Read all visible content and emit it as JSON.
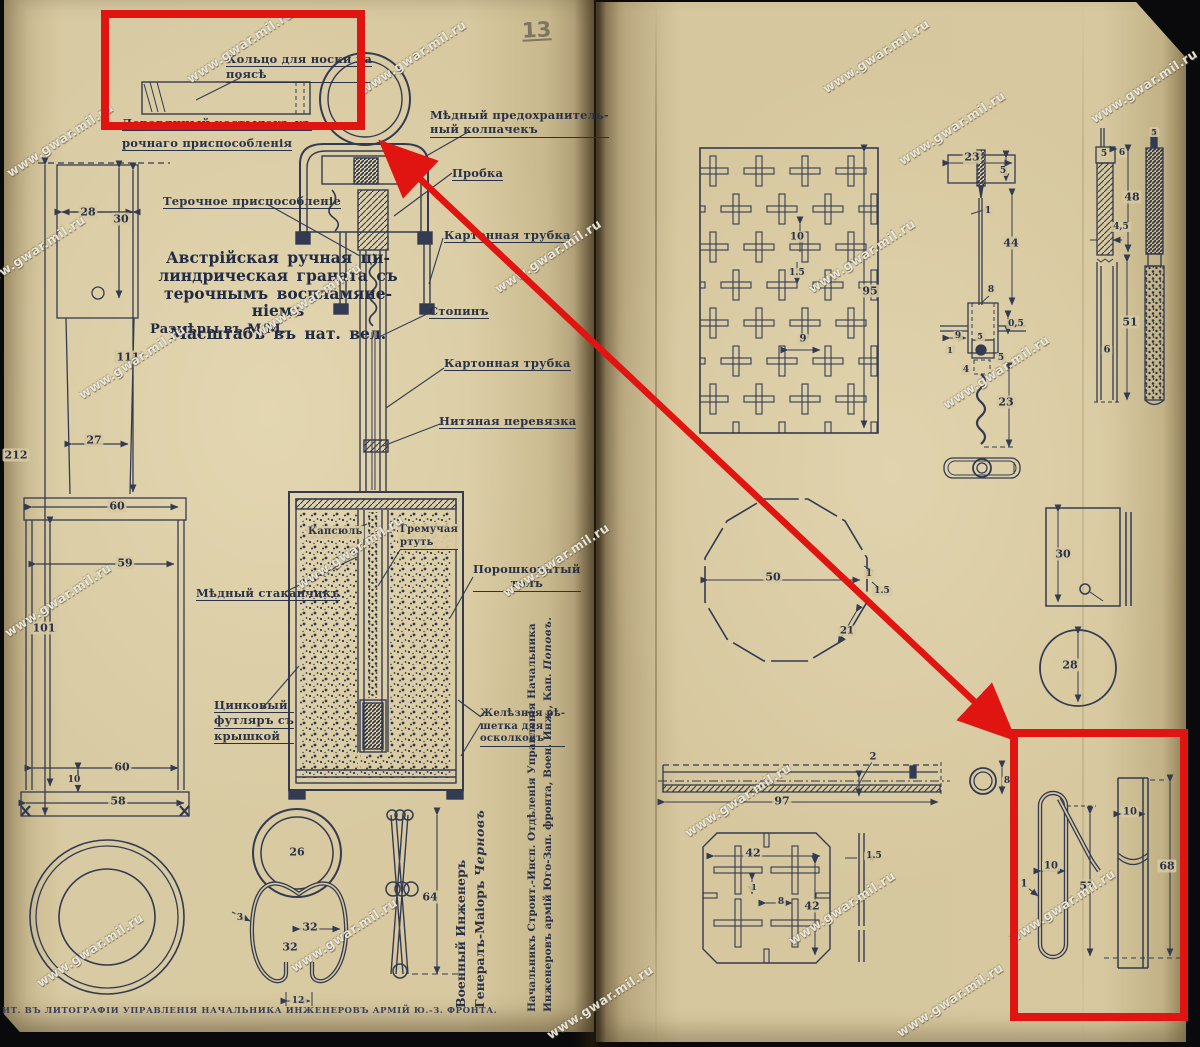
{
  "watermark_text": "www.gwar.mil.ru",
  "page_number": "13",
  "title": {
    "lines": [
      "Австрійская  ручная  ци-",
      "линдрическая  граната съ",
      "терочнымъ  воспламяне-",
      "ніемъ"
    ],
    "scale": "Масштабъ  въ  нат.  вел.",
    "units": "Размѣры  въ  М/М."
  },
  "footer": "ИТ.  ВЪ  ЛИТОГРАФІИ  УПРАВЛЕНІЯ  НАЧАЛЬНИКА  ИНЖЕНЕРОВЪ  АРМІЙ  Ю.-З.  ФРОНТА.",
  "signatures": {
    "engineer_line1": "Военный  Инженеръ",
    "engineer_line2": "Генералъ-Маіоръ  ",
    "engineer_name": "Черновъ",
    "chief_line1": "Начальникъ  Строит.-Инсп.  Отдѣленія  Управленія  Начальника",
    "chief_line2": "Инженеровъ  армій  Юго-Зап.  фронта,  Воен.  Инж.,  Кап.  ",
    "chief_name": "Поповъ."
  },
  "labels": [
    {
      "id": "label-belt-ring",
      "x": 226,
      "y": 52,
      "u": "all",
      "lines": [
        "Кольцо  для  носки   на",
        "поясѣ"
      ]
    },
    {
      "id": "label-wooden-toggle",
      "x": 122,
      "y": 116,
      "u": "all",
      "lines": [
        "Деревянный  костылекъ  къ"
      ]
    },
    {
      "id": "label-wooden-toggle-2",
      "x": 122,
      "y": 136,
      "u": "all",
      "lines": [
        "рочнаго  приспособленія"
      ]
    },
    {
      "id": "label-copper-cap",
      "x": 430,
      "y": 108,
      "u": "last",
      "lines": [
        "Мѣдный   предохранитель-",
        "ный  колпачекъ"
      ]
    },
    {
      "id": "label-cork",
      "x": 452,
      "y": 166,
      "u": "all",
      "lines": [
        "Пробка"
      ]
    },
    {
      "id": "label-friction-device",
      "x": 163,
      "y": 194,
      "u": "all",
      "lines": [
        "Терочное  приспособленіе"
      ]
    },
    {
      "id": "label-cardboard-tube-1",
      "x": 444,
      "y": 228,
      "u": "all",
      "lines": [
        "Картонная  трубка"
      ]
    },
    {
      "id": "label-stopin",
      "x": 429,
      "y": 304,
      "u": "all",
      "lines": [
        "Стопинъ"
      ]
    },
    {
      "id": "label-cardboard-tube-2",
      "x": 444,
      "y": 356,
      "u": "all",
      "lines": [
        "Картонная  трубка"
      ]
    },
    {
      "id": "label-thread-binding",
      "x": 439,
      "y": 414,
      "u": "all",
      "lines": [
        "Нитяная  перевязка"
      ]
    },
    {
      "id": "label-capsule",
      "x": 306,
      "y": 526,
      "bg": true,
      "fs": 10,
      "lines": [
        "Капсюль"
      ]
    },
    {
      "id": "label-mercury-fulminate",
      "x": 398,
      "y": 524,
      "u": "last",
      "bg": true,
      "fs": 10,
      "lines": [
        "Гремучая",
        "ртуть"
      ]
    },
    {
      "id": "label-powdered-tol",
      "x": 473,
      "y": 562,
      "u": "last",
      "ta": "center",
      "lines": [
        "Порошковатый",
        "толъ"
      ]
    },
    {
      "id": "label-copper-cup",
      "x": 196,
      "y": 586,
      "u": "all",
      "lines": [
        "Мѣдный  стаканчикъ"
      ]
    },
    {
      "id": "label-zinc-case",
      "x": 214,
      "y": 698,
      "u": "all",
      "lines": [
        "Цинковый",
        "футляръ съ",
        "крышкой"
      ]
    },
    {
      "id": "label-iron-grate",
      "x": 480,
      "y": 708,
      "u": "last",
      "fs": 10,
      "lines": [
        "Желѣзная рѣ-",
        "шетка  для",
        "осколковъ"
      ]
    }
  ],
  "dimensions": [
    {
      "v": "28",
      "x": 88,
      "y": 212
    },
    {
      "v": "30",
      "x": 121,
      "y": 219
    },
    {
      "v": "111",
      "x": 128,
      "y": 357
    },
    {
      "v": "27",
      "x": 94,
      "y": 440
    },
    {
      "v": "212",
      "x": 16,
      "y": 455
    },
    {
      "v": "60",
      "x": 117,
      "y": 506
    },
    {
      "v": "59",
      "x": 125,
      "y": 563
    },
    {
      "v": "101",
      "x": 44,
      "y": 628
    },
    {
      "v": "60",
      "x": 122,
      "y": 767
    },
    {
      "v": "10",
      "x": 74,
      "y": 780,
      "fs": 9
    },
    {
      "v": "58",
      "x": 118,
      "y": 801
    },
    {
      "v": "26",
      "x": 297,
      "y": 852
    },
    {
      "v": "3",
      "x": 240,
      "y": 918,
      "fs": 9
    },
    {
      "v": "32",
      "x": 310,
      "y": 927
    },
    {
      "v": "32",
      "x": 290,
      "y": 947
    },
    {
      "v": "12",
      "x": 298,
      "y": 1001,
      "fs": 9
    },
    {
      "v": "64",
      "x": 430,
      "y": 897
    },
    {
      "v": "10",
      "x": 797,
      "y": 237,
      "fs": 10
    },
    {
      "v": "1.5",
      "x": 797,
      "y": 273,
      "fs": 9
    },
    {
      "v": "9",
      "x": 803,
      "y": 339,
      "fs": 10
    },
    {
      "v": "95",
      "x": 870,
      "y": 291
    },
    {
      "v": "23",
      "x": 972,
      "y": 157
    },
    {
      "v": "5",
      "x": 1003,
      "y": 171,
      "fs": 9
    },
    {
      "v": "1",
      "x": 988,
      "y": 211,
      "fs": 9
    },
    {
      "v": "44",
      "x": 1011,
      "y": 243
    },
    {
      "v": "8",
      "x": 991,
      "y": 290,
      "fs": 9
    },
    {
      "v": "0,5",
      "x": 1016,
      "y": 324,
      "fs": 9
    },
    {
      "v": "9",
      "x": 958,
      "y": 336,
      "fs": 9
    },
    {
      "v": "5",
      "x": 980,
      "y": 336,
      "fs": 8
    },
    {
      "v": "1",
      "x": 950,
      "y": 350,
      "fs": 8
    },
    {
      "v": "5",
      "x": 1001,
      "y": 358,
      "fs": 9
    },
    {
      "v": "4",
      "x": 966,
      "y": 370,
      "fs": 9
    },
    {
      "v": "23",
      "x": 1006,
      "y": 402
    },
    {
      "v": "5",
      "x": 1104,
      "y": 154,
      "fs": 9
    },
    {
      "v": "6",
      "x": 1122,
      "y": 153,
      "fs": 9
    },
    {
      "v": "48",
      "x": 1132,
      "y": 197
    },
    {
      "v": "4,5",
      "x": 1121,
      "y": 227,
      "fs": 9
    },
    {
      "v": "51",
      "x": 1130,
      "y": 322
    },
    {
      "v": "6",
      "x": 1107,
      "y": 350,
      "fs": 10
    },
    {
      "v": "5",
      "x": 1154,
      "y": 132,
      "fs": 8
    },
    {
      "v": "50",
      "x": 773,
      "y": 577
    },
    {
      "v": "1",
      "x": 869,
      "y": 574,
      "fs": 9
    },
    {
      "v": "1.5",
      "x": 882,
      "y": 591,
      "fs": 9
    },
    {
      "v": "21",
      "x": 847,
      "y": 631,
      "fs": 10
    },
    {
      "v": "30",
      "x": 1063,
      "y": 554
    },
    {
      "v": "28",
      "x": 1070,
      "y": 665
    },
    {
      "v": "2",
      "x": 873,
      "y": 757,
      "fs": 10
    },
    {
      "v": "97",
      "x": 782,
      "y": 801
    },
    {
      "v": "8",
      "x": 1007,
      "y": 781,
      "fs": 9
    },
    {
      "v": "42",
      "x": 753,
      "y": 853
    },
    {
      "v": "42",
      "x": 812,
      "y": 906
    },
    {
      "v": "1",
      "x": 754,
      "y": 887,
      "fs": 8
    },
    {
      "v": "8",
      "x": 781,
      "y": 902,
      "fs": 9
    },
    {
      "v": "1.5",
      "x": 874,
      "y": 856,
      "fs": 9
    },
    {
      "v": "10",
      "x": 1051,
      "y": 866,
      "fs": 10
    },
    {
      "v": "1",
      "x": 1024,
      "y": 884,
      "fs": 10
    },
    {
      "v": "57",
      "x": 1087,
      "y": 886
    },
    {
      "v": "10",
      "x": 1130,
      "y": 812,
      "fs": 10
    },
    {
      "v": "68",
      "x": 1167,
      "y": 866
    }
  ],
  "watermarks": [
    {
      "x": 240,
      "y": 46
    },
    {
      "x": 413,
      "y": 57
    },
    {
      "x": 60,
      "y": 140
    },
    {
      "x": 32,
      "y": 252
    },
    {
      "x": 132,
      "y": 362
    },
    {
      "x": 308,
      "y": 300
    },
    {
      "x": 350,
      "y": 552
    },
    {
      "x": 58,
      "y": 600
    },
    {
      "x": 90,
      "y": 950
    },
    {
      "x": 344,
      "y": 935
    },
    {
      "x": 548,
      "y": 256
    },
    {
      "x": 556,
      "y": 560
    },
    {
      "x": 600,
      "y": 1002
    },
    {
      "x": 876,
      "y": 56
    },
    {
      "x": 952,
      "y": 128
    },
    {
      "x": 1144,
      "y": 86
    },
    {
      "x": 862,
      "y": 256
    },
    {
      "x": 996,
      "y": 372
    },
    {
      "x": 738,
      "y": 800
    },
    {
      "x": 842,
      "y": 908
    },
    {
      "x": 950,
      "y": 1000
    },
    {
      "x": 1062,
      "y": 906
    }
  ],
  "annotation_color": "#e01410",
  "ink_color": "#333b52"
}
